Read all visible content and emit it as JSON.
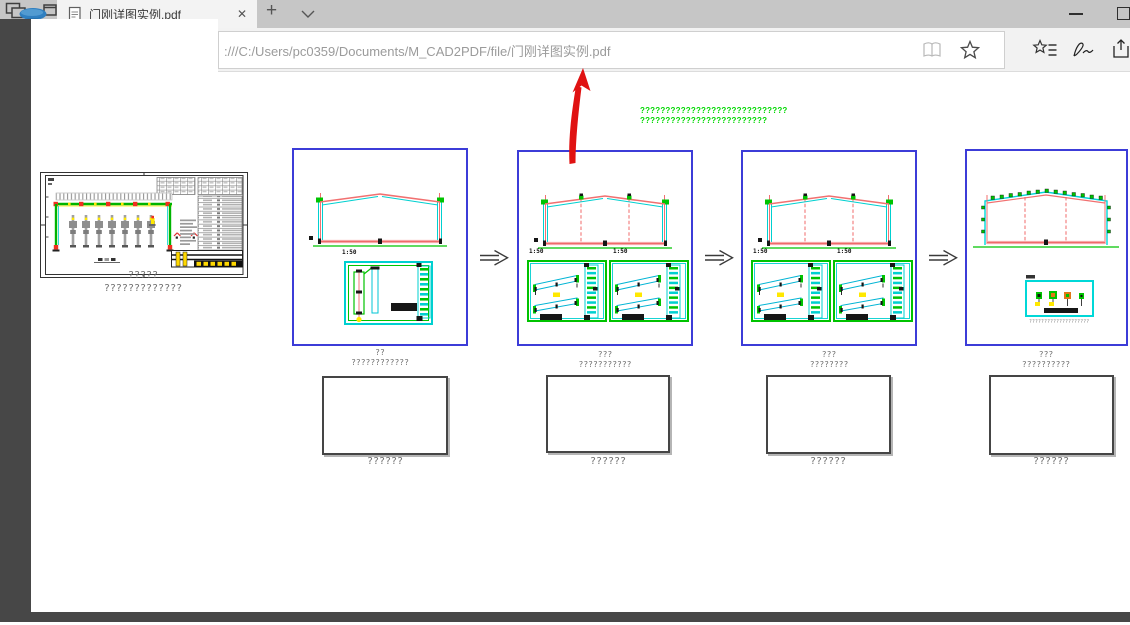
{
  "browser": {
    "tab_title": "门刚详图实例.pdf",
    "close_tab_glyph": "✕",
    "new_tab_glyph": "+",
    "url": ":///C:/Users/pc0359/Documents/M_CAD2PDF/file/门刚详图实例.pdf"
  },
  "pdf_page": {
    "green_note": {
      "line1": "?????????????????????????????",
      "line2": "?????????????????????????"
    },
    "sheet": {
      "caption1": "?????",
      "caption2": "?????????????"
    },
    "panels": [
      {
        "title": "??",
        "subtitle": "????????????",
        "scales": [
          "1:50"
        ]
      },
      {
        "title": "???",
        "subtitle": "???????????",
        "scales": [
          "1:50",
          "1:50"
        ]
      },
      {
        "title": "???",
        "subtitle": "????????",
        "scales": [
          "1:50",
          "1:50"
        ]
      },
      {
        "title": "???",
        "subtitle": "??????????",
        "inner_caption": "????????????????????"
      }
    ],
    "placeholder_boxes": [
      {
        "caption": "??????"
      },
      {
        "caption": "??????"
      },
      {
        "caption": "??????"
      },
      {
        "caption": "??????"
      }
    ]
  },
  "colors": {
    "panel_border_blue": "#3c3cd8",
    "cad_green": "#00c300",
    "cad_cyan": "#00d0d0",
    "cad_red": "#f17070",
    "note_green": "#00d800",
    "annotation_red": "#e01212",
    "highlight_yellow": "#ffe800"
  }
}
